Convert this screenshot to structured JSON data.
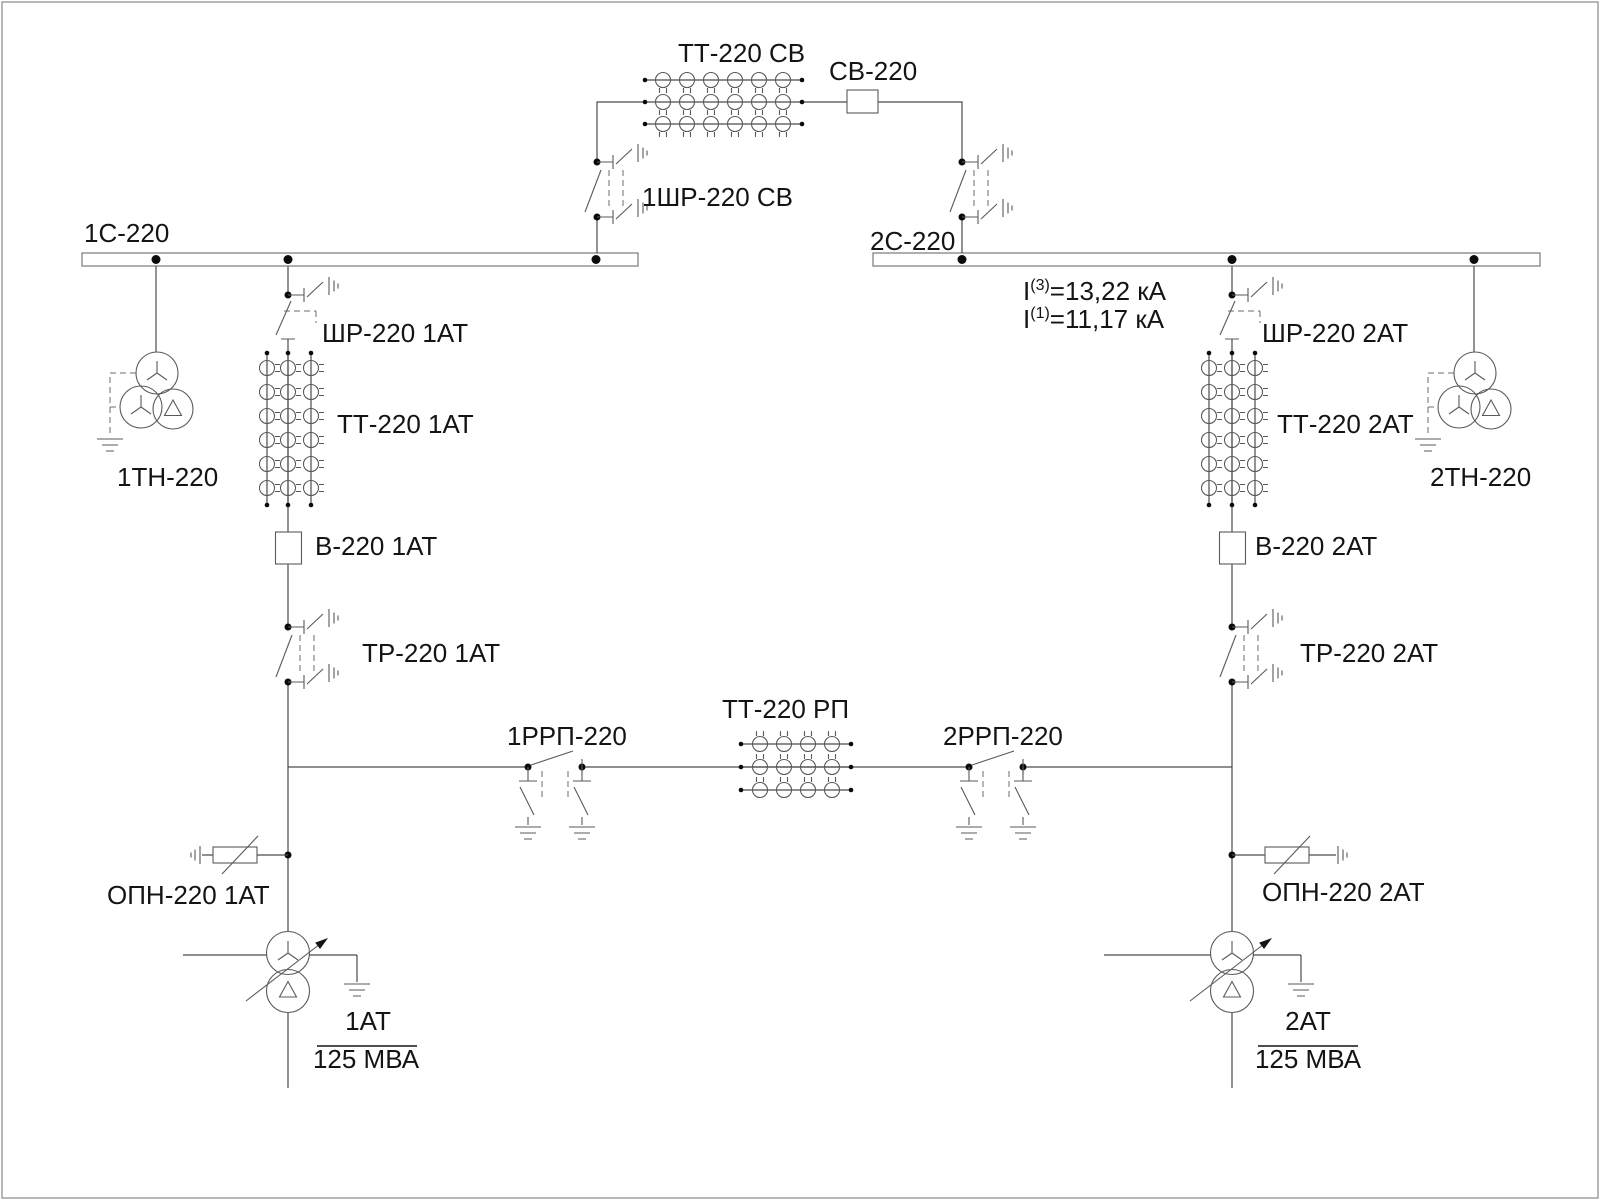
{
  "buses": {
    "bus1_label": "1С-220",
    "bus2_label": "2С-220"
  },
  "coupler": {
    "ct_label": "ТТ-220 СВ",
    "breaker_label": "СВ-220",
    "disconnector_label": "1ШР-220 СВ"
  },
  "fault": {
    "i3_base": "I",
    "i3_sup": "(3)",
    "i3_rest": "=13,22 кА",
    "i1_base": "I",
    "i1_sup": "(1)",
    "i1_rest": "=11,17 кА"
  },
  "bay1": {
    "bus_disconnector": "ШР-220 1АТ",
    "ct": "ТТ-220 1АТ",
    "breaker": "В-220 1АТ",
    "tr_disconnector": "ТР-220 1АТ",
    "arrester": "ОПН-220 1АТ",
    "vt": "1ТН-220",
    "transformer": "1АТ",
    "rating": "125 МВА"
  },
  "bay2": {
    "bus_disconnector": "ШР-220 2АТ",
    "ct": "ТТ-220 2АТ",
    "breaker": "В-220 2АТ",
    "tr_disconnector": "ТР-220 2АТ",
    "arrester": "ОПН-220 2АТ",
    "vt": "2ТН-220",
    "transformer": "2АТ",
    "rating": "125 МВА"
  },
  "link": {
    "disconnector1_label": "1РРП-220",
    "ct_label": "ТТ-220 РП",
    "disconnector2_label": "2РРП-220"
  }
}
